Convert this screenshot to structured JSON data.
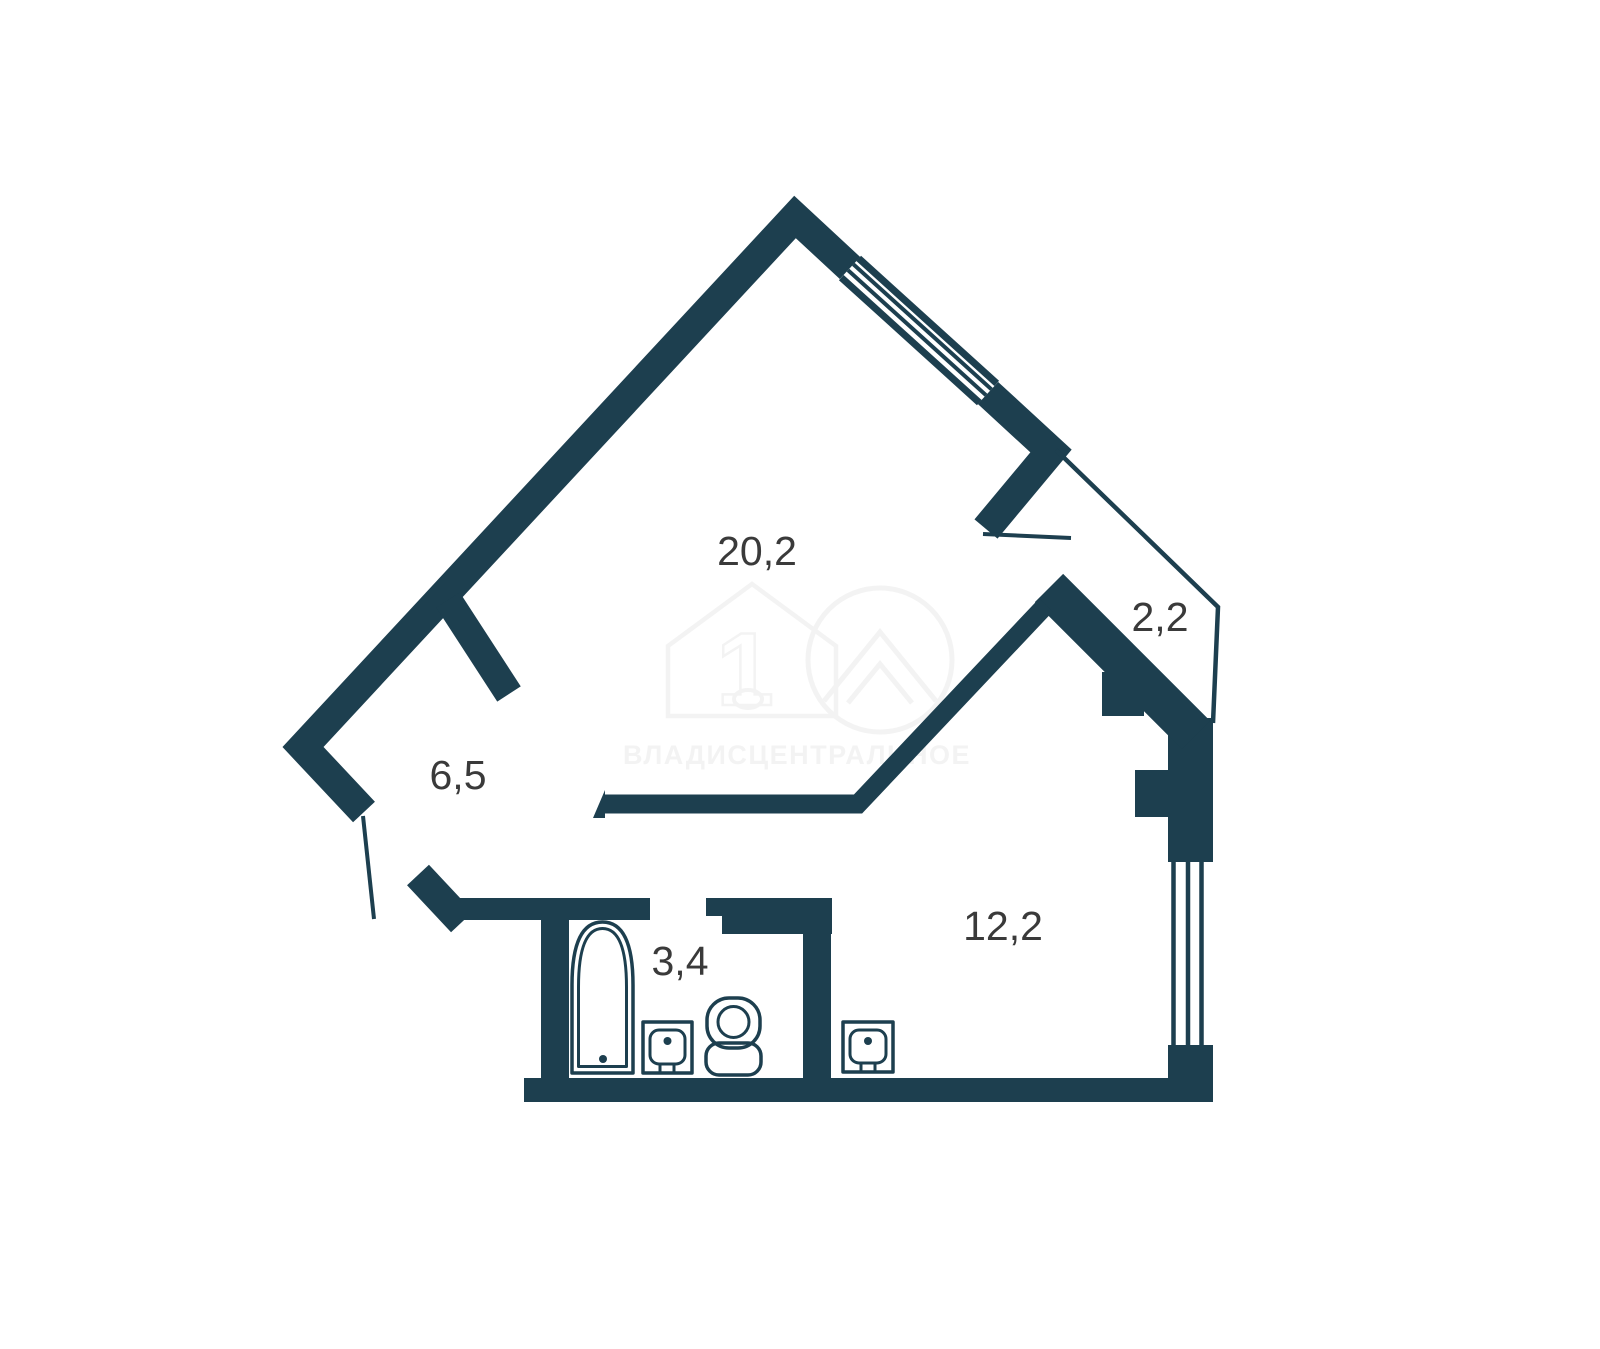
{
  "plan": {
    "type": "apartment-floor-plan",
    "wall_color": "#1d3f4f",
    "label_color": "#3a3a3a",
    "rooms": {
      "living": {
        "area_label": "20,2"
      },
      "balcony": {
        "area_label": "2,2"
      },
      "hallway": {
        "area_label": "6,5"
      },
      "bathroom": {
        "area_label": "3,4"
      },
      "kitchen": {
        "area_label": "12,2"
      }
    },
    "fixtures": {
      "bathtub_icon": "bathtub",
      "bath_sink_icon": "sink",
      "toilet_icon": "toilet",
      "kitchen_sink_icon": "sink"
    },
    "windows": [
      "top-right-wall-window",
      "right-wall-window"
    ],
    "watermark": {
      "text": "ВЛАДИСЦЕНТРАЛЬНОЕ",
      "logo_number": "1",
      "color": "#f3f3f3"
    }
  }
}
